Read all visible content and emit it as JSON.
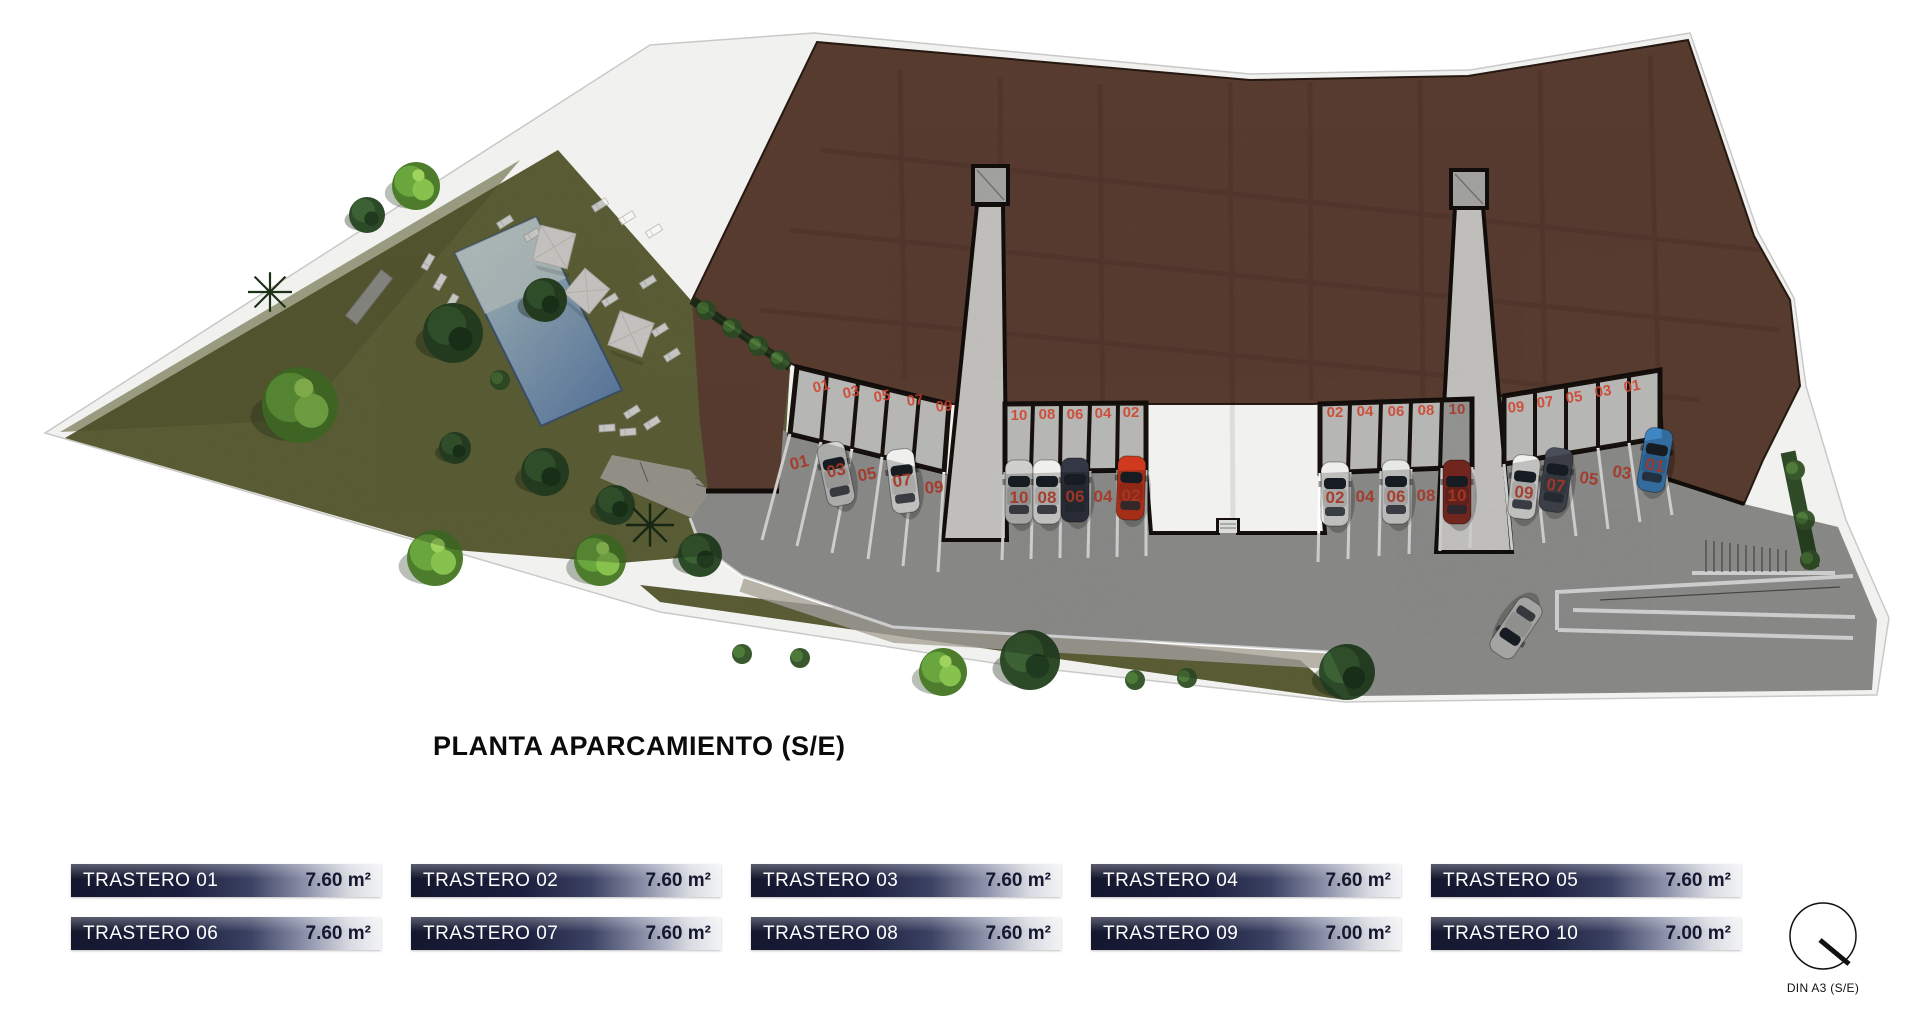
{
  "title": "PLANTA APARCAMIENTO (S/E)",
  "din_label": "DIN A3 (S/E)",
  "legend": {
    "items": [
      {
        "label": "TRASTERO 01",
        "area": "7.60 m²"
      },
      {
        "label": "TRASTERO 02",
        "area": "7.60 m²"
      },
      {
        "label": "TRASTERO 03",
        "area": "7.60 m²"
      },
      {
        "label": "TRASTERO 04",
        "area": "7.60 m²"
      },
      {
        "label": "TRASTERO 05",
        "area": "7.60 m²"
      },
      {
        "label": "TRASTERO 06",
        "area": "7.60 m²"
      },
      {
        "label": "TRASTERO 07",
        "area": "7.60 m²"
      },
      {
        "label": "TRASTERO 08",
        "area": "7.60 m²"
      },
      {
        "label": "TRASTERO 09",
        "area": "7.00 m²"
      },
      {
        "label": "TRASTERO 10",
        "area": "7.00 m²"
      }
    ]
  },
  "plan": {
    "left_block": {
      "storage": [
        "01",
        "03",
        "05",
        "07",
        "09",
        "10",
        "08",
        "06",
        "04",
        "02"
      ],
      "parking": [
        "01",
        "03",
        "05",
        "07",
        "09",
        "10",
        "08",
        "06",
        "04",
        "02"
      ]
    },
    "right_block": {
      "storage": [
        "02",
        "04",
        "06",
        "08",
        "10",
        "09",
        "07",
        "05",
        "03",
        "01"
      ],
      "parking": [
        "02",
        "04",
        "06",
        "08",
        "10",
        "09",
        "07",
        "05",
        "03",
        "01"
      ]
    },
    "cars": {
      "left_block_occupied": [
        "03",
        "07",
        "10",
        "08",
        "06",
        "02"
      ],
      "right_block_occupied": [
        "02",
        "06",
        "10",
        "09",
        "07",
        "01"
      ],
      "road_cars": 1
    }
  },
  "colors": {
    "roof_brown": "#6e4a3b",
    "pavement_gray": "#a9a9a7",
    "storage_floor": "#b6b6b4",
    "grass_olive": "#6e7240",
    "pool_blue": "#8fb0cd",
    "legend_navy": "#14172e",
    "number_red": "#cf4630",
    "wall_black": "#16110d",
    "site_band": "#f1f1ef",
    "car_red": "#cf3a1f",
    "car_blue": "#3f86c4"
  }
}
